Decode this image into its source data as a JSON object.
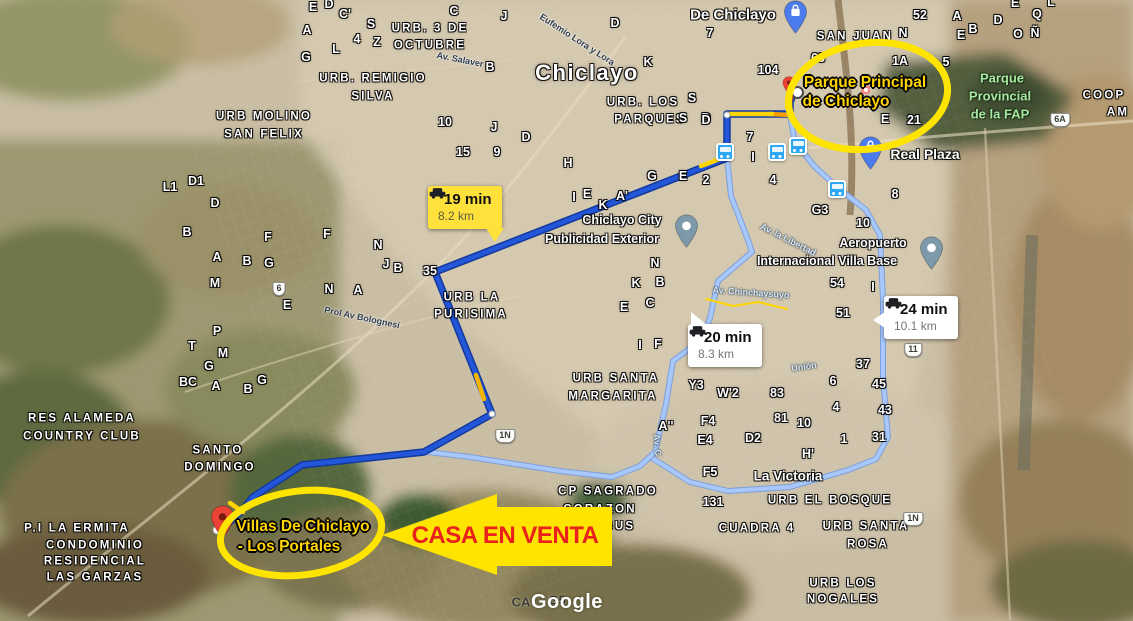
{
  "watermark": "Google",
  "colors": {
    "route_main": "#2456d9",
    "route_main_casing": "#123a9c",
    "route_alt": "#a8c7fa",
    "route_alt_casing": "#7e9fd8",
    "traffic_red": "#d93025",
    "traffic_orange": "#f59e00",
    "traffic_yellow": "#ffd500",
    "annotation_yellow": "#ffe400",
    "annotation_text_gold": "#ffd400",
    "arrow_text_red": "#e9201c",
    "badge_yellow": "#ffe13b",
    "pin_blue": "#4b7bec",
    "pin_slate": "#7e9aaa",
    "pin_red": "#ea4335",
    "transit_blue": "#2fa8f3"
  },
  "badges": [
    {
      "time": "19 min",
      "distance": "8.2 km",
      "style": "yellow"
    },
    {
      "time": "20 min",
      "distance": "8.3 km",
      "style": "white"
    },
    {
      "time": "24 min",
      "distance": "10.1 km",
      "style": "white"
    }
  ],
  "annotations": {
    "origin": {
      "line1": "Parque Principal",
      "line2": "de Chiclayo"
    },
    "destination": {
      "line1": "Villas De Chiclayo",
      "line2": "- Los Portales"
    },
    "arrow_label": "CASA EN VENTA"
  },
  "map": {
    "labels": [
      {
        "t": "Chiclayo",
        "x": 587,
        "y": 73,
        "k": "city"
      },
      {
        "t": "De Chiclayo",
        "x": 733,
        "y": 15,
        "k": "big"
      },
      {
        "t": "La Victoria",
        "x": 788,
        "y": 476,
        "k": "big",
        "s": 13.5
      },
      {
        "t": "URB. 3 DE",
        "x": 430,
        "y": 29,
        "k": "district"
      },
      {
        "t": "OCTUBRE",
        "x": 430,
        "y": 46,
        "k": "district"
      },
      {
        "t": "URB. REMIGIO",
        "x": 373,
        "y": 79,
        "k": "district"
      },
      {
        "t": "SILVA",
        "x": 373,
        "y": 97,
        "k": "district"
      },
      {
        "t": "URB MOLINO",
        "x": 264,
        "y": 117,
        "k": "district"
      },
      {
        "t": "SAN FELIX",
        "x": 264,
        "y": 135,
        "k": "district"
      },
      {
        "t": "URB. LOS",
        "x": 643,
        "y": 103,
        "k": "district"
      },
      {
        "t": "PARQUES",
        "x": 650,
        "y": 120,
        "k": "district"
      },
      {
        "t": "SAN JUAN",
        "x": 855,
        "y": 37,
        "k": "district"
      },
      {
        "t": "URB LA",
        "x": 472,
        "y": 298,
        "k": "district"
      },
      {
        "t": "PURISIMA",
        "x": 471,
        "y": 315,
        "k": "district"
      },
      {
        "t": "URB SANTA",
        "x": 616,
        "y": 379,
        "k": "district"
      },
      {
        "t": "MARGARITA",
        "x": 613,
        "y": 397,
        "k": "district"
      },
      {
        "t": "RES ALAMEDA",
        "x": 82,
        "y": 419,
        "k": "district"
      },
      {
        "t": "COUNTRY CLUB",
        "x": 82,
        "y": 437,
        "k": "district"
      },
      {
        "t": "SANTO",
        "x": 218,
        "y": 451,
        "k": "district"
      },
      {
        "t": "DOMINGO",
        "x": 220,
        "y": 468,
        "k": "district"
      },
      {
        "t": "P.I LA ERMITA",
        "x": 77,
        "y": 529,
        "k": "district"
      },
      {
        "t": "CONDOMINIO",
        "x": 95,
        "y": 546,
        "k": "district"
      },
      {
        "t": "RESIDENCIAL",
        "x": 95,
        "y": 562,
        "k": "district"
      },
      {
        "t": "LAS GARZAS",
        "x": 95,
        "y": 578,
        "k": "district"
      },
      {
        "t": "CP SAGRADO",
        "x": 608,
        "y": 492,
        "k": "district"
      },
      {
        "t": "CORAZON",
        "x": 600,
        "y": 510,
        "k": "district"
      },
      {
        "t": "DE JESUS",
        "x": 598,
        "y": 527,
        "k": "district"
      },
      {
        "t": "URB EL BOSQUE",
        "x": 830,
        "y": 501,
        "k": "district"
      },
      {
        "t": "CUADRA 4",
        "x": 757,
        "y": 529,
        "k": "district"
      },
      {
        "t": "URB SANTA",
        "x": 866,
        "y": 527,
        "k": "district"
      },
      {
        "t": "ROSA",
        "x": 868,
        "y": 545,
        "k": "district"
      },
      {
        "t": "URB LOS",
        "x": 843,
        "y": 584,
        "k": "district"
      },
      {
        "t": "NOGALES",
        "x": 843,
        "y": 600,
        "k": "district"
      },
      {
        "t": "COOP",
        "x": 1104,
        "y": 96,
        "k": "district"
      },
      {
        "t": "AM",
        "x": 1118,
        "y": 113,
        "k": "district"
      },
      {
        "t": "Parque",
        "x": 1002,
        "y": 78,
        "k": "park"
      },
      {
        "t": "Provincial",
        "x": 1000,
        "y": 96,
        "k": "park"
      },
      {
        "t": "de la FAP",
        "x": 1000,
        "y": 114,
        "k": "park"
      },
      {
        "t": "Real Plaza",
        "x": 925,
        "y": 154,
        "k": "place",
        "s": 14
      },
      {
        "t": "Chiclayo City",
        "x": 622,
        "y": 220,
        "k": "place"
      },
      {
        "t": "Publicidad Exterior",
        "x": 602,
        "y": 239,
        "k": "place"
      },
      {
        "t": "Aeropuerto",
        "x": 873,
        "y": 243,
        "k": "place"
      },
      {
        "t": "Internacional Villa Base",
        "x": 827,
        "y": 261,
        "k": "place"
      },
      {
        "t": "Av. Salaver",
        "x": 460,
        "y": 60,
        "k": "road",
        "r": 11
      },
      {
        "t": "Eufemio Lora y Lora",
        "x": 577,
        "y": 40,
        "k": "road",
        "r": 33
      },
      {
        "t": "Prol Av Bolognesi",
        "x": 362,
        "y": 318,
        "k": "road",
        "r": 12
      },
      {
        "t": "Av. Chinchaysuyo",
        "x": 751,
        "y": 293,
        "k": "roadlight",
        "r": 4
      },
      {
        "t": "Av. la Libertad",
        "x": 788,
        "y": 240,
        "k": "roadlight",
        "r": 27
      },
      {
        "t": "Unión",
        "x": 804,
        "y": 367,
        "k": "roadlight",
        "r": -8
      },
      {
        "t": "Av. C",
        "x": 657,
        "y": 445,
        "k": "roadlight",
        "r": 85
      },
      {
        "t": "E",
        "x": 313,
        "y": 7,
        "k": "letter"
      },
      {
        "t": "D",
        "x": 329,
        "y": 4,
        "k": "letter"
      },
      {
        "t": "C'",
        "x": 345,
        "y": 14,
        "k": "letter"
      },
      {
        "t": "A",
        "x": 307,
        "y": 30,
        "k": "letter"
      },
      {
        "t": "S",
        "x": 371,
        "y": 24,
        "k": "letter"
      },
      {
        "t": "4",
        "x": 357,
        "y": 39,
        "k": "letter"
      },
      {
        "t": "Z",
        "x": 377,
        "y": 42,
        "k": "letter"
      },
      {
        "t": "G",
        "x": 306,
        "y": 57,
        "k": "letter"
      },
      {
        "t": "L",
        "x": 336,
        "y": 49,
        "k": "letter"
      },
      {
        "t": "C",
        "x": 454,
        "y": 11,
        "k": "letter"
      },
      {
        "t": "J",
        "x": 504,
        "y": 16,
        "k": "letter"
      },
      {
        "t": "B",
        "x": 490,
        "y": 67,
        "k": "letter"
      },
      {
        "t": "D",
        "x": 615,
        "y": 23,
        "k": "letter"
      },
      {
        "t": "10",
        "x": 445,
        "y": 122,
        "k": "letter"
      },
      {
        "t": "J",
        "x": 494,
        "y": 127,
        "k": "letter"
      },
      {
        "t": "15",
        "x": 463,
        "y": 152,
        "k": "letter"
      },
      {
        "t": "9",
        "x": 497,
        "y": 152,
        "k": "letter"
      },
      {
        "t": "D",
        "x": 526,
        "y": 137,
        "k": "letter"
      },
      {
        "t": "H",
        "x": 568,
        "y": 163,
        "k": "letter"
      },
      {
        "t": "K",
        "x": 648,
        "y": 62,
        "k": "letter"
      },
      {
        "t": "7",
        "x": 710,
        "y": 33,
        "k": "letter"
      },
      {
        "t": "S",
        "x": 692,
        "y": 98,
        "k": "letter"
      },
      {
        "t": "S",
        "x": 683,
        "y": 118,
        "k": "letter"
      },
      {
        "t": "D",
        "x": 706,
        "y": 118,
        "k": "letter"
      },
      {
        "t": "7",
        "x": 750,
        "y": 137,
        "k": "letter"
      },
      {
        "t": "I",
        "x": 753,
        "y": 157,
        "k": "letter"
      },
      {
        "t": "E",
        "x": 683,
        "y": 176,
        "k": "letter"
      },
      {
        "t": "G",
        "x": 652,
        "y": 176,
        "k": "letter"
      },
      {
        "t": "2",
        "x": 706,
        "y": 180,
        "k": "letter"
      },
      {
        "t": "4",
        "x": 773,
        "y": 180,
        "k": "letter"
      },
      {
        "t": "I",
        "x": 574,
        "y": 197,
        "k": "letter"
      },
      {
        "t": "E",
        "x": 587,
        "y": 194,
        "k": "letter"
      },
      {
        "t": "K",
        "x": 603,
        "y": 205,
        "k": "letter"
      },
      {
        "t": "A'",
        "x": 622,
        "y": 196,
        "k": "letter"
      },
      {
        "t": "104",
        "x": 768,
        "y": 70,
        "k": "letter"
      },
      {
        "t": "68",
        "x": 818,
        "y": 58,
        "k": "letter"
      },
      {
        "t": "1A",
        "x": 900,
        "y": 61,
        "k": "letter"
      },
      {
        "t": "5",
        "x": 946,
        "y": 62,
        "k": "letter"
      },
      {
        "t": "52",
        "x": 920,
        "y": 15,
        "k": "letter"
      },
      {
        "t": "A",
        "x": 957,
        "y": 16,
        "k": "letter"
      },
      {
        "t": "B",
        "x": 973,
        "y": 29,
        "k": "letter"
      },
      {
        "t": "E",
        "x": 961,
        "y": 35,
        "k": "letter"
      },
      {
        "t": "D",
        "x": 998,
        "y": 20,
        "k": "letter"
      },
      {
        "t": "Q",
        "x": 1037,
        "y": 14,
        "k": "letter"
      },
      {
        "t": "E",
        "x": 1015,
        "y": 3,
        "k": "letter"
      },
      {
        "t": "L",
        "x": 1051,
        "y": 2,
        "k": "letter"
      },
      {
        "t": "O",
        "x": 1018,
        "y": 34,
        "k": "letter"
      },
      {
        "t": "Ñ",
        "x": 1035,
        "y": 33,
        "k": "letter"
      },
      {
        "t": "N",
        "x": 903,
        "y": 33,
        "k": "letter"
      },
      {
        "t": "E",
        "x": 885,
        "y": 119,
        "k": "letter"
      },
      {
        "t": "21",
        "x": 914,
        "y": 120,
        "k": "letter"
      },
      {
        "t": "G3",
        "x": 820,
        "y": 210,
        "k": "letter"
      },
      {
        "t": "10",
        "x": 863,
        "y": 223,
        "k": "letter"
      },
      {
        "t": "8",
        "x": 895,
        "y": 194,
        "k": "letter"
      },
      {
        "t": "N",
        "x": 655,
        "y": 263,
        "k": "letter"
      },
      {
        "t": "K",
        "x": 636,
        "y": 283,
        "k": "letter"
      },
      {
        "t": "B",
        "x": 660,
        "y": 282,
        "k": "letter"
      },
      {
        "t": "E",
        "x": 624,
        "y": 307,
        "k": "letter"
      },
      {
        "t": "C",
        "x": 650,
        "y": 303,
        "k": "letter"
      },
      {
        "t": "I",
        "x": 640,
        "y": 345,
        "k": "letter"
      },
      {
        "t": "F",
        "x": 658,
        "y": 344,
        "k": "letter"
      },
      {
        "t": "54",
        "x": 837,
        "y": 283,
        "k": "letter"
      },
      {
        "t": "I",
        "x": 873,
        "y": 287,
        "k": "letter"
      },
      {
        "t": "51",
        "x": 843,
        "y": 313,
        "k": "letter"
      },
      {
        "t": "37",
        "x": 863,
        "y": 364,
        "k": "letter"
      },
      {
        "t": "6",
        "x": 833,
        "y": 381,
        "k": "letter"
      },
      {
        "t": "45",
        "x": 879,
        "y": 384,
        "k": "letter"
      },
      {
        "t": "4",
        "x": 836,
        "y": 407,
        "k": "letter"
      },
      {
        "t": "43",
        "x": 885,
        "y": 410,
        "k": "letter"
      },
      {
        "t": "83",
        "x": 777,
        "y": 393,
        "k": "letter"
      },
      {
        "t": "81",
        "x": 781,
        "y": 418,
        "k": "letter"
      },
      {
        "t": "10",
        "x": 804,
        "y": 423,
        "k": "letter"
      },
      {
        "t": "1",
        "x": 844,
        "y": 439,
        "k": "letter"
      },
      {
        "t": "31",
        "x": 879,
        "y": 437,
        "k": "letter"
      },
      {
        "t": "Y3",
        "x": 696,
        "y": 385,
        "k": "letter"
      },
      {
        "t": "W'2",
        "x": 728,
        "y": 393,
        "k": "letter"
      },
      {
        "t": "A''",
        "x": 666,
        "y": 426,
        "k": "letter"
      },
      {
        "t": "F4",
        "x": 708,
        "y": 421,
        "k": "letter"
      },
      {
        "t": "E4",
        "x": 705,
        "y": 440,
        "k": "letter"
      },
      {
        "t": "D2",
        "x": 753,
        "y": 438,
        "k": "letter"
      },
      {
        "t": "H'",
        "x": 808,
        "y": 454,
        "k": "letter"
      },
      {
        "t": "F5",
        "x": 710,
        "y": 472,
        "k": "letter"
      },
      {
        "t": "131",
        "x": 713,
        "y": 502,
        "k": "letter"
      },
      {
        "t": "L1",
        "x": 170,
        "y": 187,
        "k": "letter"
      },
      {
        "t": "D1",
        "x": 196,
        "y": 181,
        "k": "letter"
      },
      {
        "t": "D",
        "x": 215,
        "y": 203,
        "k": "letter"
      },
      {
        "t": "B",
        "x": 187,
        "y": 232,
        "k": "letter"
      },
      {
        "t": "F",
        "x": 268,
        "y": 237,
        "k": "letter"
      },
      {
        "t": "F",
        "x": 327,
        "y": 234,
        "k": "letter"
      },
      {
        "t": "N",
        "x": 378,
        "y": 245,
        "k": "letter"
      },
      {
        "t": "A",
        "x": 217,
        "y": 257,
        "k": "letter"
      },
      {
        "t": "B",
        "x": 247,
        "y": 261,
        "k": "letter"
      },
      {
        "t": "G",
        "x": 269,
        "y": 263,
        "k": "letter"
      },
      {
        "t": "M",
        "x": 215,
        "y": 283,
        "k": "letter"
      },
      {
        "t": "E",
        "x": 287,
        "y": 305,
        "k": "letter"
      },
      {
        "t": "N",
        "x": 329,
        "y": 289,
        "k": "letter"
      },
      {
        "t": "A",
        "x": 358,
        "y": 290,
        "k": "letter"
      },
      {
        "t": "J",
        "x": 386,
        "y": 264,
        "k": "letter"
      },
      {
        "t": "B",
        "x": 398,
        "y": 268,
        "k": "letter"
      },
      {
        "t": "35",
        "x": 430,
        "y": 271,
        "k": "letter"
      },
      {
        "t": "P",
        "x": 217,
        "y": 331,
        "k": "letter"
      },
      {
        "t": "T",
        "x": 192,
        "y": 346,
        "k": "letter"
      },
      {
        "t": "M",
        "x": 223,
        "y": 353,
        "k": "letter"
      },
      {
        "t": "G",
        "x": 209,
        "y": 366,
        "k": "letter"
      },
      {
        "t": "BC",
        "x": 188,
        "y": 382,
        "k": "letter"
      },
      {
        "t": "A",
        "x": 216,
        "y": 386,
        "k": "letter"
      },
      {
        "t": "G",
        "x": 262,
        "y": 380,
        "k": "letter"
      },
      {
        "t": "B",
        "x": 248,
        "y": 389,
        "k": "letter"
      },
      {
        "t": "D",
        "x": 706,
        "y": 120,
        "k": "letter"
      },
      {
        "t": "CA",
        "x": 521,
        "y": 602,
        "k": "dark"
      },
      {
        "t": "G5",
        "x": 557,
        "y": 600,
        "k": "dark"
      }
    ],
    "shields": [
      {
        "t": "6",
        "x": 279,
        "y": 289
      },
      {
        "t": "6A",
        "x": 1060,
        "y": 120
      },
      {
        "t": "11",
        "x": 913,
        "y": 350
      },
      {
        "t": "1N",
        "x": 505,
        "y": 436
      },
      {
        "t": "1N",
        "x": 913,
        "y": 519
      }
    ],
    "transit_stations": [
      {
        "x": 725,
        "y": 152
      },
      {
        "x": 777,
        "y": 152
      },
      {
        "x": 798,
        "y": 146
      },
      {
        "x": 837,
        "y": 189
      }
    ],
    "pins": [
      {
        "name": "mercado-pin",
        "x": 795,
        "y": 34,
        "color": "#4b7bec",
        "glyph": "bag"
      },
      {
        "name": "real-plaza-pin",
        "x": 870,
        "y": 170,
        "color": "#4b7bec",
        "glyph": "bag"
      },
      {
        "name": "chiclayo-city-pin",
        "x": 686,
        "y": 248,
        "color": "#7e9aaa",
        "glyph": "dot"
      },
      {
        "name": "aeropuerto-pin",
        "x": 931,
        "y": 270,
        "color": "#7e9aaa",
        "glyph": "dot"
      },
      {
        "name": "destination-pin",
        "x": 222,
        "y": 539,
        "color": "#ea4335",
        "glyph": "reddot"
      },
      {
        "name": "origin-mini-pin",
        "x": 789,
        "y": 95,
        "color": "#ea4335",
        "glyph": "reddot",
        "small": true
      }
    ]
  }
}
